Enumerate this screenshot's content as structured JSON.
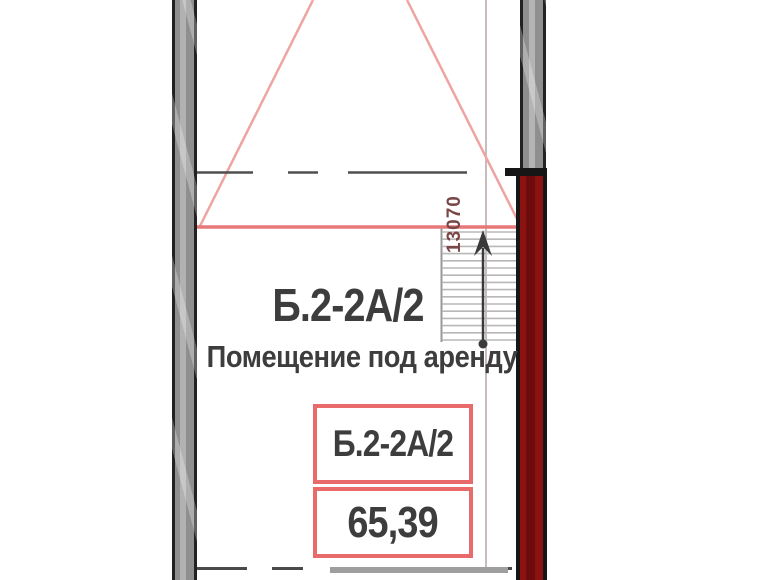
{
  "drawing": {
    "unit_code": "Б.2-2А/2",
    "unit_description": "Помещение под аренду",
    "label_box": {
      "unit_code": "Б.2-2А/2",
      "area_value": "65,39"
    },
    "stair_dimension": "13070",
    "stairs": {
      "tread_count": 16
    },
    "colors": {
      "wall_gray": "#8f8f8f",
      "wall_edge": "#222222",
      "wall_maroon": "#7e0d0d",
      "line_red_light": "#efa3a3",
      "line_red": "#e87878",
      "box_border_red": "#e86a6a",
      "text_dark": "#3d3d3d",
      "dimension_text": "#7a4646"
    }
  }
}
